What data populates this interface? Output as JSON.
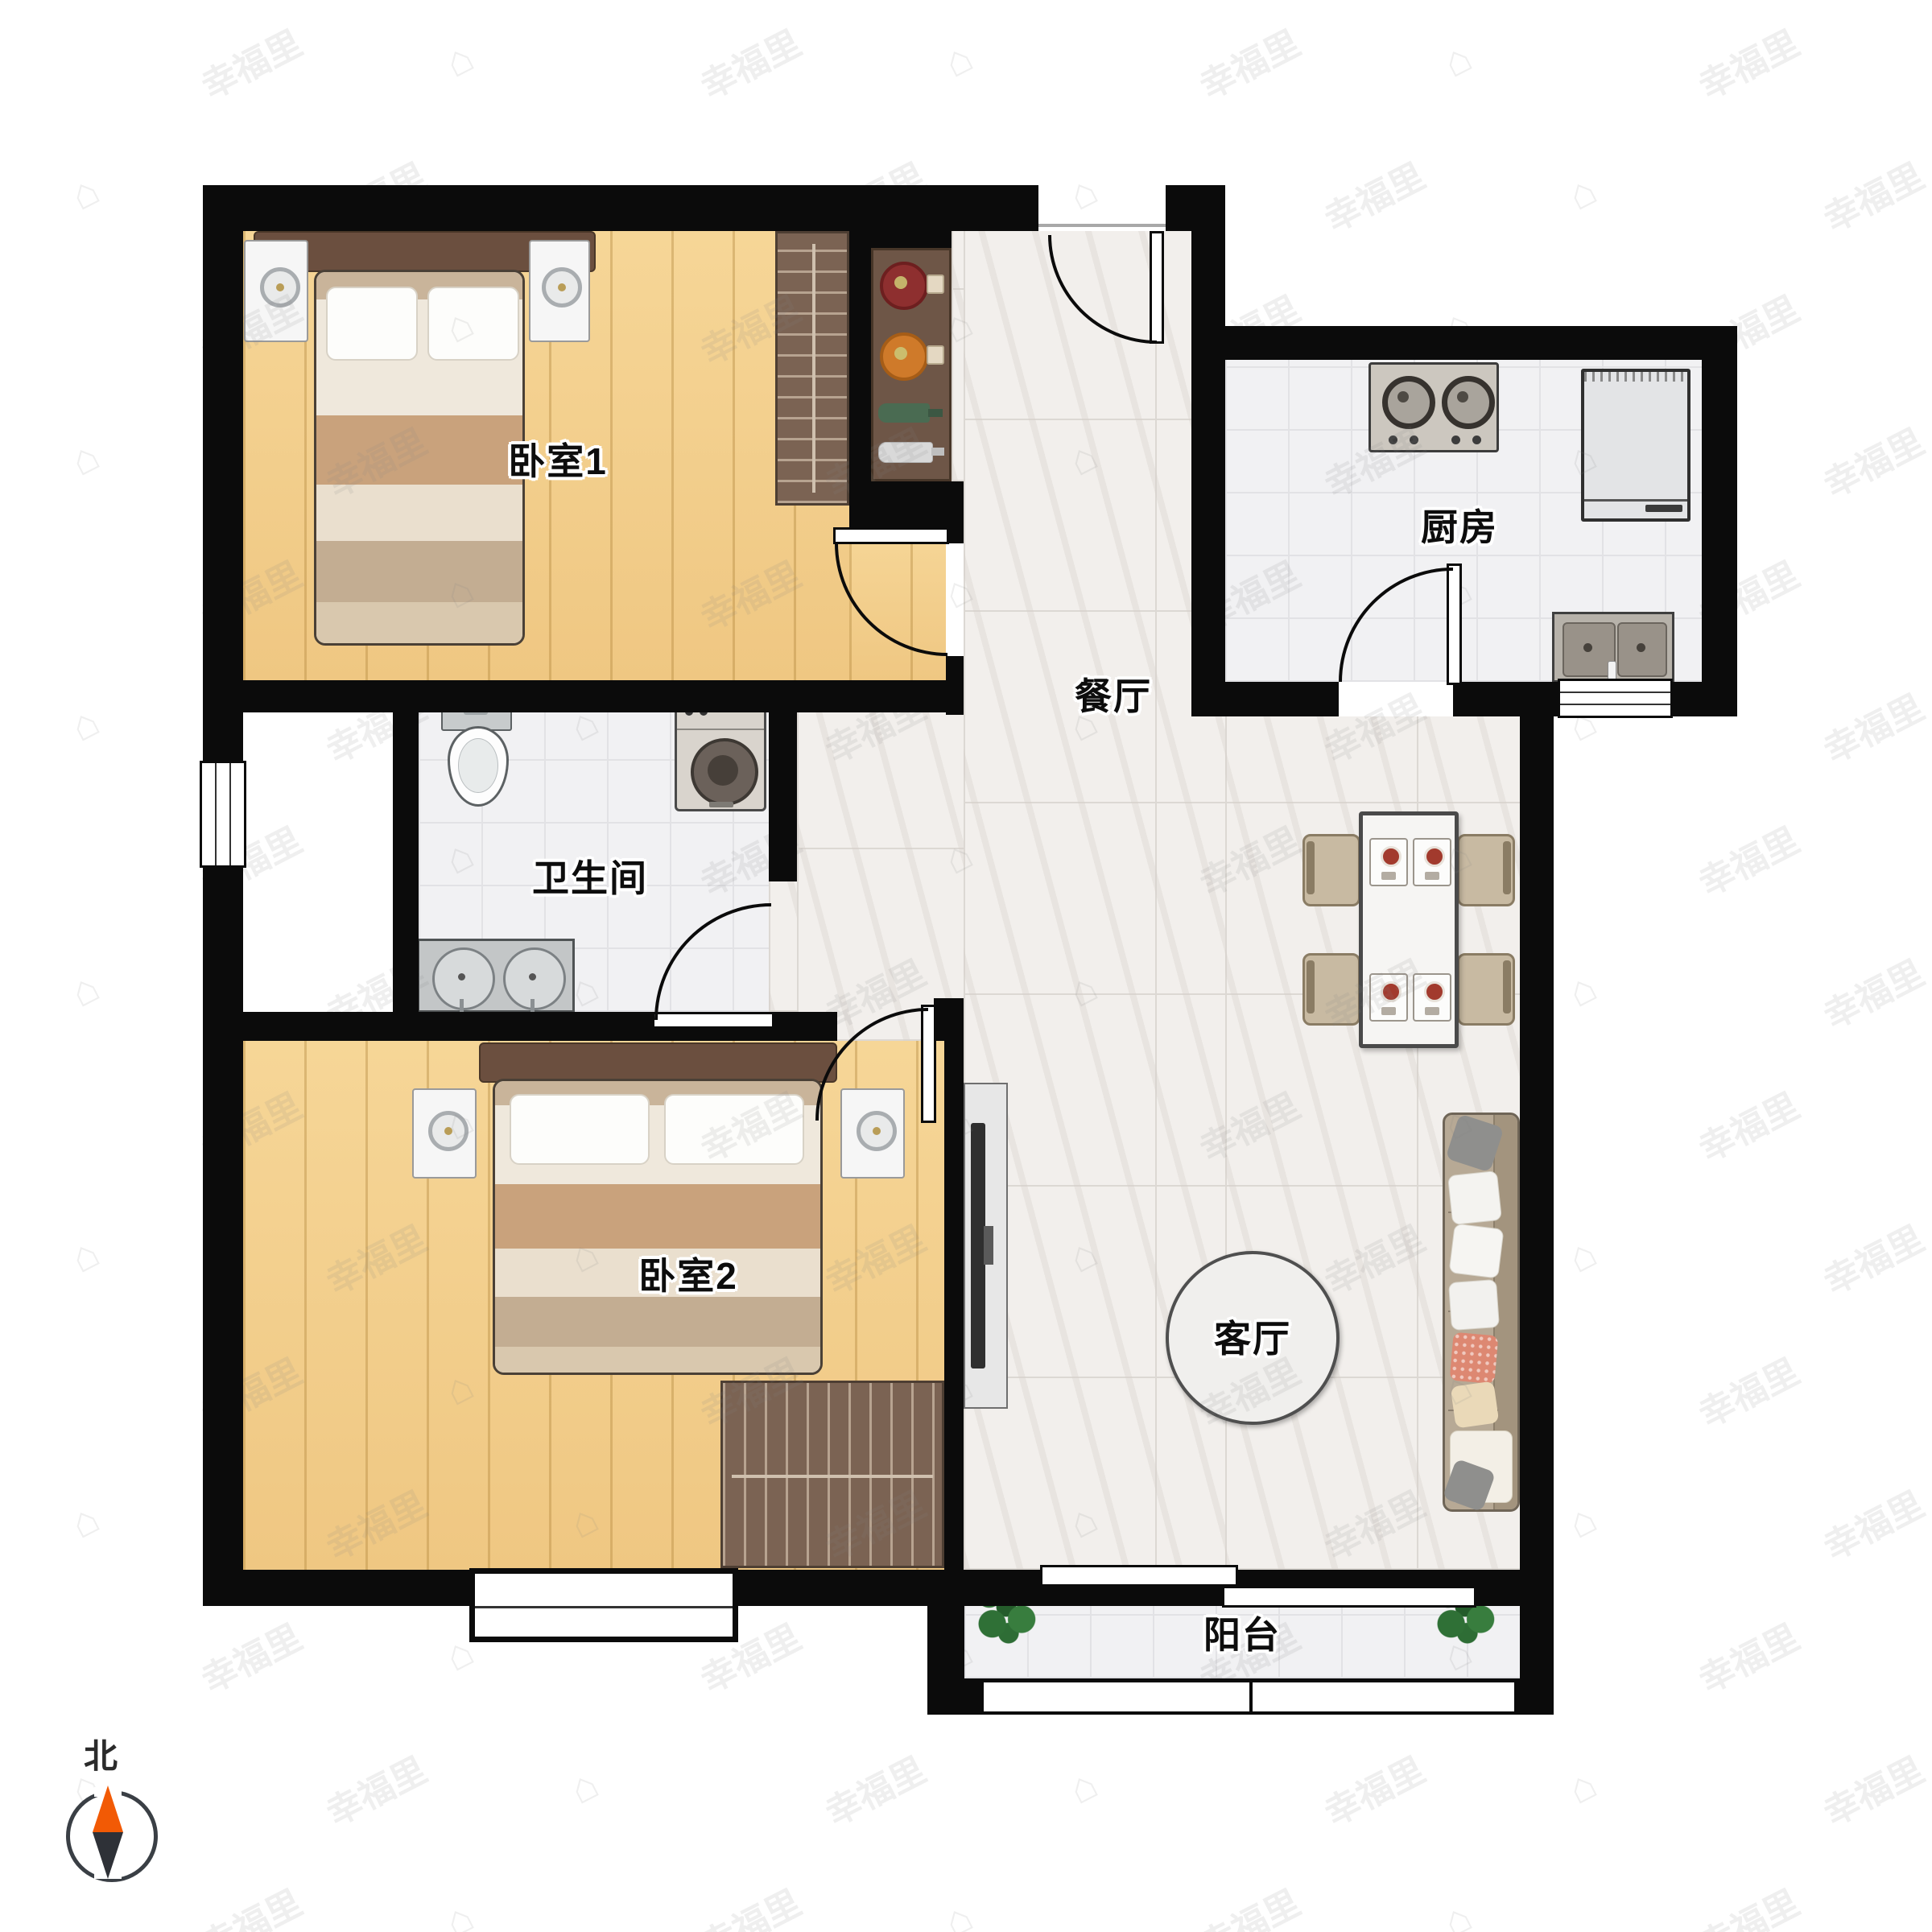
{
  "plan_title": "two-bedroom-apartment-floor-plan",
  "rooms": [
    {
      "id": "bedroom1",
      "label": "卧室1"
    },
    {
      "id": "bathroom",
      "label": "卫生间"
    },
    {
      "id": "bedroom2",
      "label": "卧室2"
    },
    {
      "id": "dining",
      "label": "餐厅"
    },
    {
      "id": "kitchen",
      "label": "厨房"
    },
    {
      "id": "living",
      "label": "客厅"
    },
    {
      "id": "balcony",
      "label": "阳台"
    }
  ],
  "compass": {
    "north_label": "北",
    "north_color": "#f25a05",
    "south_color": "#2e3137"
  },
  "watermark": {
    "text": "幸福里",
    "icon": "house"
  },
  "colors": {
    "wall": "#0b0b0b",
    "wood_floor": "#f3cd8f",
    "tile_floor": "#f1f1f3",
    "marble_floor": "#f2efec",
    "wardrobe": "#7b6353",
    "sofa": "#b7a995",
    "accent_red_bowl": "#8e2f2f",
    "accent_orange_bowl": "#cf7a2a"
  }
}
